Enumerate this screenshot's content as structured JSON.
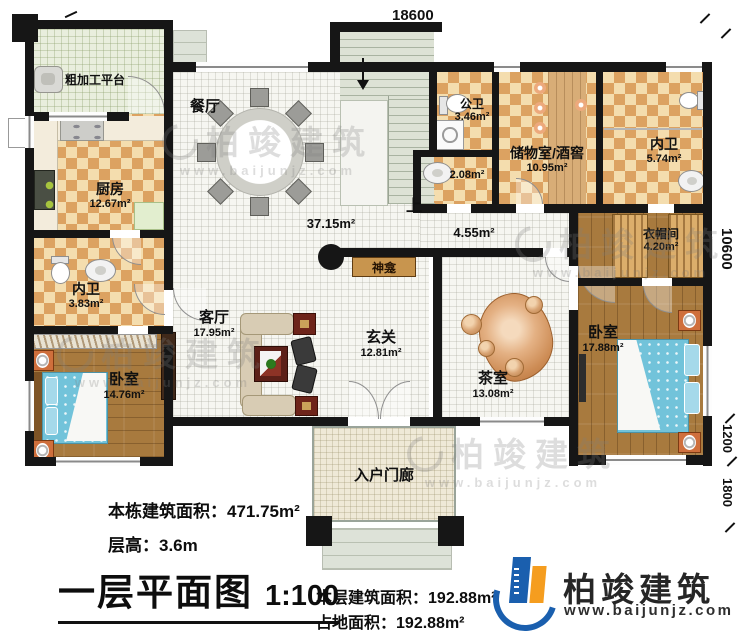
{
  "plan": {
    "dim_top": "18600",
    "dim_right": "10600",
    "dim_offset_mid": "1200",
    "dim_offset_bottom": "1800",
    "stairs_up": "上",
    "rooms": {
      "prep": {
        "name": "粗加工平台"
      },
      "kitchen": {
        "name": "厨房",
        "area": "12.67m²"
      },
      "dining": {
        "name": "餐厅"
      },
      "open_area": {
        "area": "37.15m²"
      },
      "hallway": {
        "area": "4.55m²"
      },
      "public_bath": {
        "name": "公卫",
        "area": "3.46m²"
      },
      "small_bath": {
        "area": "2.08m²"
      },
      "storage": {
        "name": "储物室/酒窖",
        "area": "10.95m²"
      },
      "ensuite_top": {
        "name": "内卫",
        "area": "5.74m²"
      },
      "cloakroom": {
        "name": "衣帽间",
        "area": "4.20m²"
      },
      "shrine": {
        "name": "神龛"
      },
      "ensuite_left": {
        "name": "内卫",
        "area": "3.83m²"
      },
      "living": {
        "name": "客厅",
        "area": "17.95m²"
      },
      "foyer": {
        "name": "玄关",
        "area": "12.81m²"
      },
      "tea_room": {
        "name": "茶室",
        "area": "13.08m²"
      },
      "bedroom_right": {
        "name": "卧室",
        "area": "17.88m²"
      },
      "bedroom_left": {
        "name": "卧室",
        "area": "14.76m²"
      },
      "porch": {
        "name": "入户门廊"
      }
    }
  },
  "footer": {
    "building_area_label": "本栋建筑面积：",
    "building_area_value": "471.75m²",
    "floor_height_label": "层高：",
    "floor_height_value": "3.6m",
    "plan_title": "一层平面图",
    "plan_scale": "1:100",
    "floor_area_label": "本层建筑面积：",
    "floor_area_value": "192.88m²",
    "footprint_label": "占地面积：",
    "footprint_value": "192.88m²"
  },
  "brand": {
    "name": "柏竣建筑",
    "url": "www.baijunjz.com"
  },
  "watermark": {
    "name": "柏竣建筑",
    "url": "www.baijunjz.com"
  },
  "colors": {
    "brand_blue": "#1a5fae",
    "brand_orange": "#f59d1f",
    "wall": "#161616",
    "checker": "#dca261"
  }
}
